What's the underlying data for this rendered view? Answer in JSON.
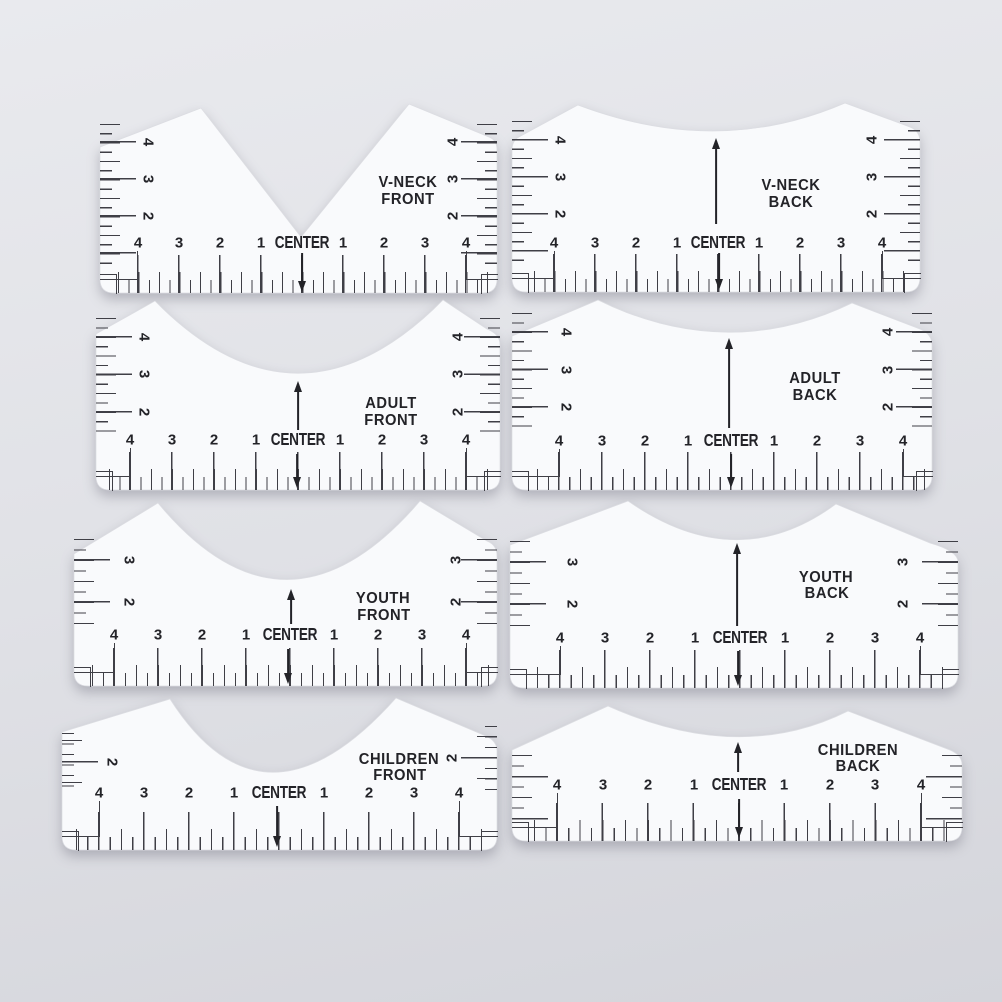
{
  "colors": {
    "background_top": "#e9eaee",
    "background_mid": "#e0e1e6",
    "background_bottom": "#d4d5db",
    "ruler": "#f9fafc",
    "ink": "#3f3f46",
    "text": "#232328"
  },
  "rulers": [
    {
      "name": "v-neck-front",
      "line1": "V-NECK",
      "line2": "FRONT",
      "center": "CENTER",
      "bottom": [
        "4",
        "3",
        "2",
        "1",
        "1",
        "2",
        "3",
        "4"
      ],
      "left_side": [
        "4",
        "3",
        "2"
      ],
      "right_side": [
        "4",
        "3",
        "2"
      ]
    },
    {
      "name": "v-neck-back",
      "line1": "V-NECK",
      "line2": "BACK",
      "center": "CENTER",
      "bottom": [
        "4",
        "3",
        "2",
        "1",
        "1",
        "2",
        "3",
        "4"
      ],
      "left_side": [
        "4",
        "3",
        "2"
      ],
      "right_side": [
        "4",
        "3",
        "2"
      ]
    },
    {
      "name": "adult-front",
      "line1": "ADULT",
      "line2": "FRONT",
      "center": "CENTER",
      "bottom": [
        "4",
        "3",
        "2",
        "1",
        "1",
        "2",
        "3",
        "4"
      ],
      "left_side": [
        "4",
        "3",
        "2"
      ],
      "right_side": [
        "4",
        "3",
        "2"
      ]
    },
    {
      "name": "adult-back",
      "line1": "ADULT",
      "line2": "BACK",
      "center": "CENTER",
      "bottom": [
        "4",
        "3",
        "2",
        "1",
        "1",
        "2",
        "3",
        "4"
      ],
      "left_side": [
        "4",
        "3",
        "2"
      ],
      "right_side": [
        "4",
        "3",
        "2"
      ]
    },
    {
      "name": "youth-front",
      "line1": "YOUTH",
      "line2": "FRONT",
      "center": "CENTER",
      "bottom": [
        "4",
        "3",
        "2",
        "1",
        "1",
        "2",
        "3",
        "4"
      ],
      "left_side": [
        "3",
        "2"
      ],
      "right_side": [
        "3",
        "2"
      ]
    },
    {
      "name": "youth-back",
      "line1": "YOUTH",
      "line2": "BACK",
      "center": "CENTER",
      "bottom": [
        "4",
        "3",
        "2",
        "1",
        "1",
        "2",
        "3",
        "4"
      ],
      "left_side": [
        "3",
        "2"
      ],
      "right_side": [
        "3",
        "2"
      ]
    },
    {
      "name": "children-front",
      "line1": "CHILDREN",
      "line2": "FRONT",
      "center": "CENTER",
      "bottom": [
        "4",
        "3",
        "2",
        "1",
        "1",
        "2",
        "3",
        "4"
      ],
      "left_side": [
        "2"
      ],
      "right_side": [
        "2"
      ]
    },
    {
      "name": "children-back",
      "line1": "CHILDREN",
      "line2": "BACK",
      "center": "CENTER",
      "bottom": [
        "4",
        "3",
        "2",
        "1",
        "1",
        "2",
        "3",
        "4"
      ],
      "left_side": [],
      "right_side": []
    }
  ]
}
